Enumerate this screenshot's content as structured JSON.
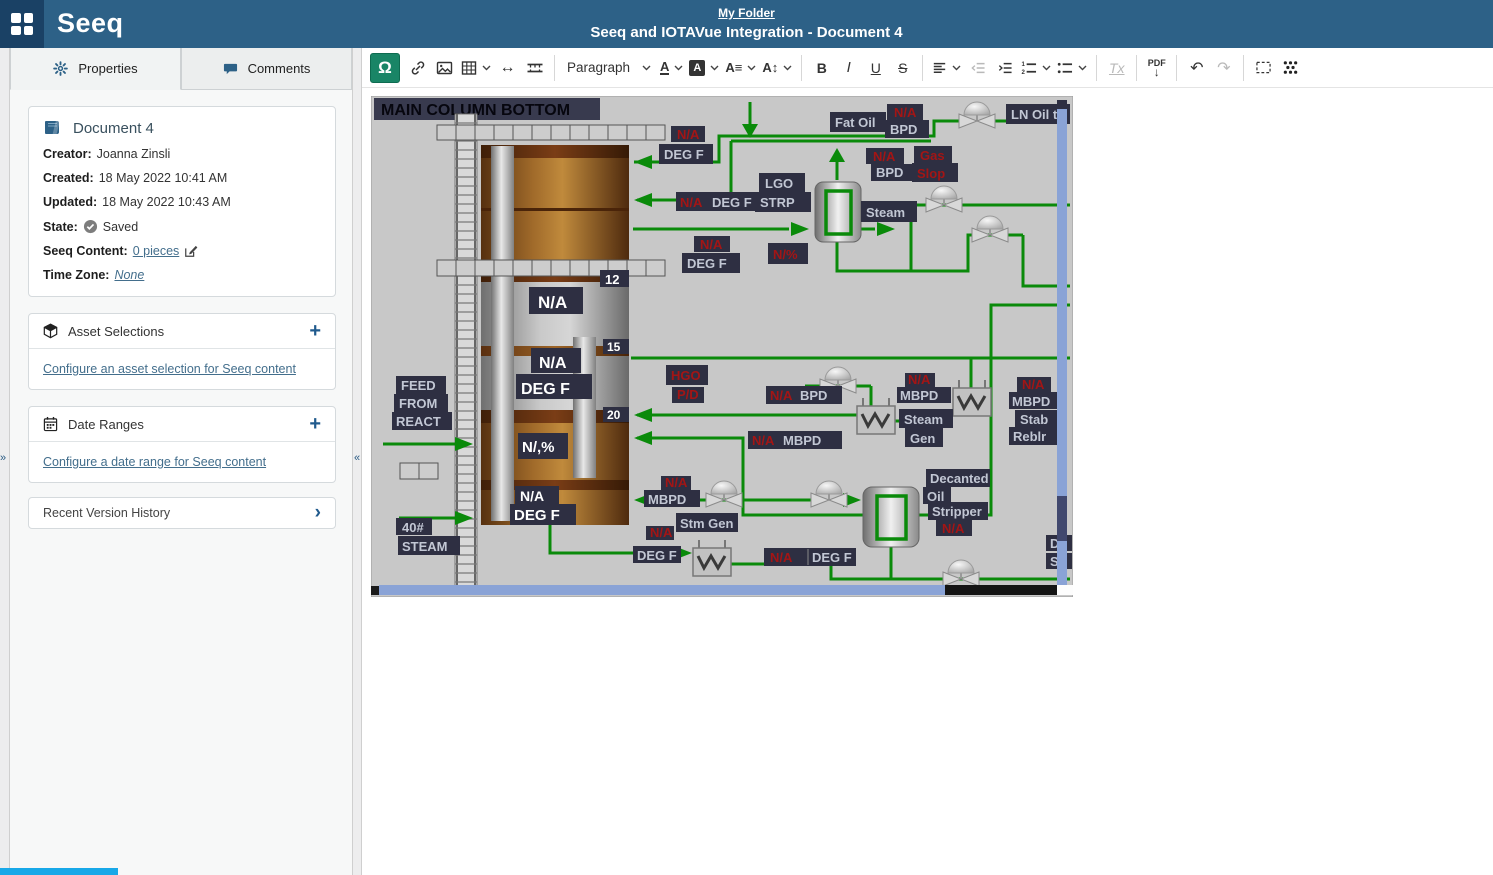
{
  "app": {
    "logo": "Seeq",
    "breadcrumb": "My Folder",
    "title": "Seeq and IOTAVue Integration - Document 4"
  },
  "sidebar": {
    "expand_chevron": "»",
    "collapse_chevron": "«",
    "tabs": [
      {
        "label": "Properties"
      },
      {
        "label": "Comments"
      }
    ],
    "document": {
      "title": "Document 4",
      "fields": [
        {
          "label": "Creator:",
          "value": "Joanna Zinsli"
        },
        {
          "label": "Created:",
          "value": "18 May 2022 10:41 AM"
        },
        {
          "label": "Updated:",
          "value": "18 May 2022 10:43 AM"
        }
      ],
      "state": {
        "label": "State:",
        "value": "Saved"
      },
      "seeq_content": {
        "label": "Seeq Content:",
        "link": "0 pieces"
      },
      "time_zone": {
        "label": "Time Zone:",
        "link": "None"
      }
    },
    "asset_selections": {
      "title": "Asset Selections",
      "plus": "+",
      "link": "Configure an asset selection for Seeq content"
    },
    "date_ranges": {
      "title": "Date Ranges",
      "plus": "+",
      "link": "Configure a date range for Seeq content"
    },
    "version_history": {
      "title": "Recent Version History",
      "chevron": "›"
    }
  },
  "toolbar": {
    "seeq_content_glyph": "Ω",
    "paragraph": "Paragraph",
    "bold": "B",
    "italic": "I",
    "underline": "U",
    "strike": "S",
    "color_glyph": "A",
    "bg_glyph": "A",
    "family_glyph": "A≡",
    "size_glyph": "A↕",
    "hr_glyph": "↔",
    "undo_glyph": "↶",
    "redo_glyph": "↷",
    "clear_format": "Tx",
    "pdf": "PDF",
    "pdf_arrow": "↓"
  },
  "diagram": {
    "title": "MAIN COLUMN BOTTOM",
    "labels": {
      "na": "N/A",
      "degf": "DEG F",
      "bpd": "BPD",
      "mbpd": "MBPD",
      "fat_oil": "Fat Oil",
      "ln_oil": "LN Oil to",
      "gas": "Gas",
      "slop": "Slop",
      "lgo": "LGO",
      "strp": "STRP",
      "steam": "Steam",
      "gen": "Gen",
      "npct": "N/%",
      "npct2": "N/,%",
      "hgo": "HGO",
      "pd": "P/D",
      "feed": "FEED",
      "from": "FROM",
      "react": "REACT",
      "s40": "40#",
      "steam_caps": "STEAM",
      "stm_gen": "Stm Gen",
      "stab": "Stab",
      "reblr": "Reblr",
      "decanted": "Decanted",
      "oil": "Oil",
      "stripper": "Stripper",
      "d": "D",
      "s": "S"
    },
    "tray_numbers": {
      "t12": "12",
      "t15": "15",
      "t20": "20"
    }
  },
  "colors": {
    "header": "#2d6187",
    "logo_block": "#1a4165",
    "accent_green": "#198566",
    "link": "#436e8c",
    "pipe_green": "#0a8a0a",
    "label_box": "#2e2f42",
    "label_red": "#a31515",
    "hmi_bg": "#c8c8c8",
    "progress_blue": "#18a8e8"
  }
}
